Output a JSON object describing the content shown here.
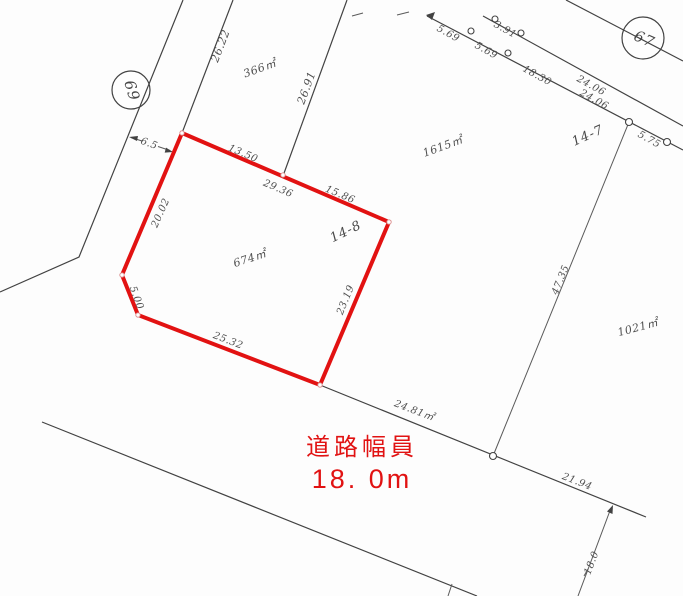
{
  "map_type": "cadastral-survey-map",
  "colors": {
    "parcel_highlight": "#e21212",
    "annotation_red": "#e11212",
    "line_black": "#424242"
  },
  "road_note": {
    "line1": "道路幅員",
    "line2": "18. 0m"
  },
  "lots": {
    "lot_14_8": "14-8",
    "lot_14_7": "14-7"
  },
  "survey_points": {
    "p69": "69",
    "p67": "67"
  },
  "areas": {
    "p366": "366㎡",
    "p674": "674㎡",
    "p1615": "1615㎡",
    "p1021": "1021㎡"
  },
  "dimensions": {
    "d26_22": "26.22",
    "d26_91": "26.91",
    "d13_50": "13.50",
    "d29_36": "29.36",
    "d15_86": "15.86",
    "d20_02": "20.02",
    "d5_00": "5.00",
    "d25_32": "25.32",
    "d23_19": "23.19",
    "d6_5": "6.5",
    "d47_35": "47.35",
    "d5_69a": "5.69",
    "d5_69b": "5.69",
    "d3_91": "3.91",
    "d18_30": "18.30",
    "d24_06a": "24.06",
    "d24_06b": "24.06",
    "d5_75": "5.75",
    "d24_81": "24.81㎡",
    "d21_94": "21.94",
    "d18_0": "18.0"
  }
}
